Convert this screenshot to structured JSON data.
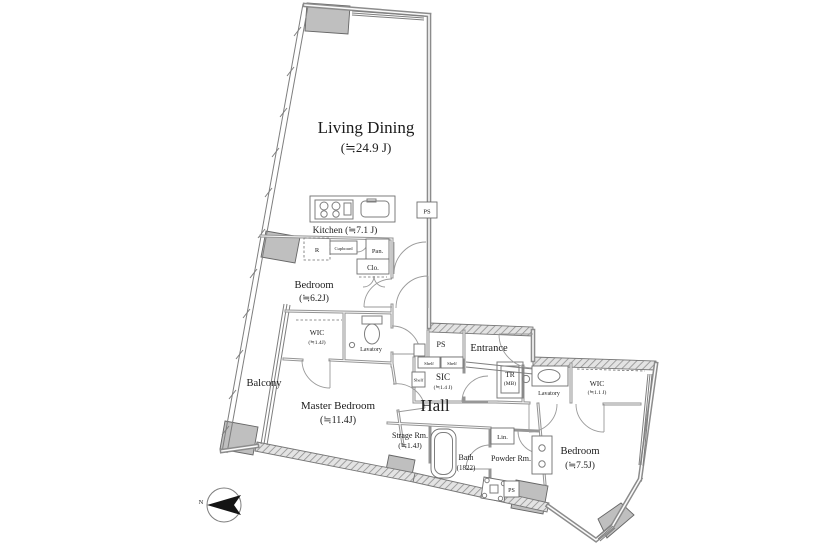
{
  "colors": {
    "background": "#ffffff",
    "wall": "#8c8c8c",
    "pillar": "#bfbfbf",
    "text": "#1b1b1b"
  },
  "rooms": {
    "living_dining": {
      "name": "Living Dining",
      "size": "(≒24.9 J)"
    },
    "kitchen": {
      "name": "Kitchen (≒7.1 J)"
    },
    "bedroom_center": {
      "name": "Bedroom",
      "size": "(≒6.2J)"
    },
    "wic_master": {
      "name": "WIC",
      "size": "(≒1.4J)"
    },
    "lavatory_toilet": {
      "name": "Lavatory"
    },
    "balcony": {
      "name": "Balcony"
    },
    "master_bedroom": {
      "name": "Master Bedroom",
      "size": "(≒11.4J)"
    },
    "hall": {
      "name": "Hall"
    },
    "entrance": {
      "name": "Entrance"
    },
    "sic": {
      "name": "SIC",
      "size": "(≒1.4 J)"
    },
    "trunk_room": {
      "name": "TR",
      "size": "(MB)"
    },
    "lavatory_basin": {
      "name": "Lavatory"
    },
    "wic_east": {
      "name": "WIC",
      "size": "(≒1.1 J)"
    },
    "bedroom_east": {
      "name": "Bedroom",
      "size": "(≒7.5J)"
    },
    "storage_room": {
      "name": "Strage Rm.",
      "size": "(≒1.4J)"
    },
    "bath": {
      "name": "Bath",
      "size": "(1822)"
    },
    "powder_room": {
      "name": "Powder Rm."
    }
  },
  "fixtures": {
    "refrigerator": "R",
    "cupboard": "Cupboard",
    "pantry": "Pan.",
    "closet": "Clo.",
    "linen": "Lin.",
    "shelf_top_left": "Shelf",
    "shelf_top_right": "Shelf",
    "shelf_side": "Shelf",
    "ps_living": "PS",
    "ps_entrance": "PS",
    "ps_powder": "PS",
    "compass_north": "N"
  }
}
